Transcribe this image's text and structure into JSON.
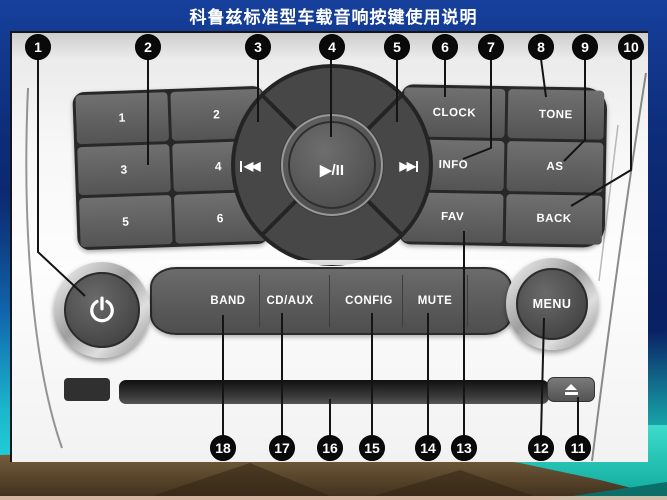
{
  "title": "科鲁兹标准型车载音响按键使用说明",
  "panel": {
    "preset_buttons": [
      "1",
      "2",
      "3",
      "4",
      "5",
      "6"
    ],
    "function_buttons": {
      "clock": "CLOCK",
      "tone": "TONE",
      "info": "INFO",
      "as": "AS",
      "fav": "FAV",
      "back": "BACK"
    },
    "transport": {
      "prev": "◀◀",
      "next": "▶▶",
      "play_pause": "▶/II"
    },
    "bottom_buttons": {
      "band": "BAND",
      "cd_aux": "CD/AUX",
      "config": "CONFIG",
      "mute": "MUTE"
    },
    "menu_knob_label": "MENU",
    "icons": {
      "power": "power-icon",
      "eject": "eject-icon"
    }
  },
  "callouts": {
    "top": [
      "1",
      "2",
      "3",
      "4",
      "5",
      "6",
      "7",
      "8",
      "9",
      "10"
    ],
    "bottom": [
      "18",
      "17",
      "16",
      "15",
      "14",
      "13",
      "12",
      "11"
    ]
  },
  "colors": {
    "background_navy": "#0b2670",
    "accent_teal": "#22d0d8",
    "landscape_brown": "#5d4a2e",
    "callout_black": "#0a0a0a",
    "panel_button_gray": "#5a5a5a",
    "title_text": "#ffffff"
  }
}
